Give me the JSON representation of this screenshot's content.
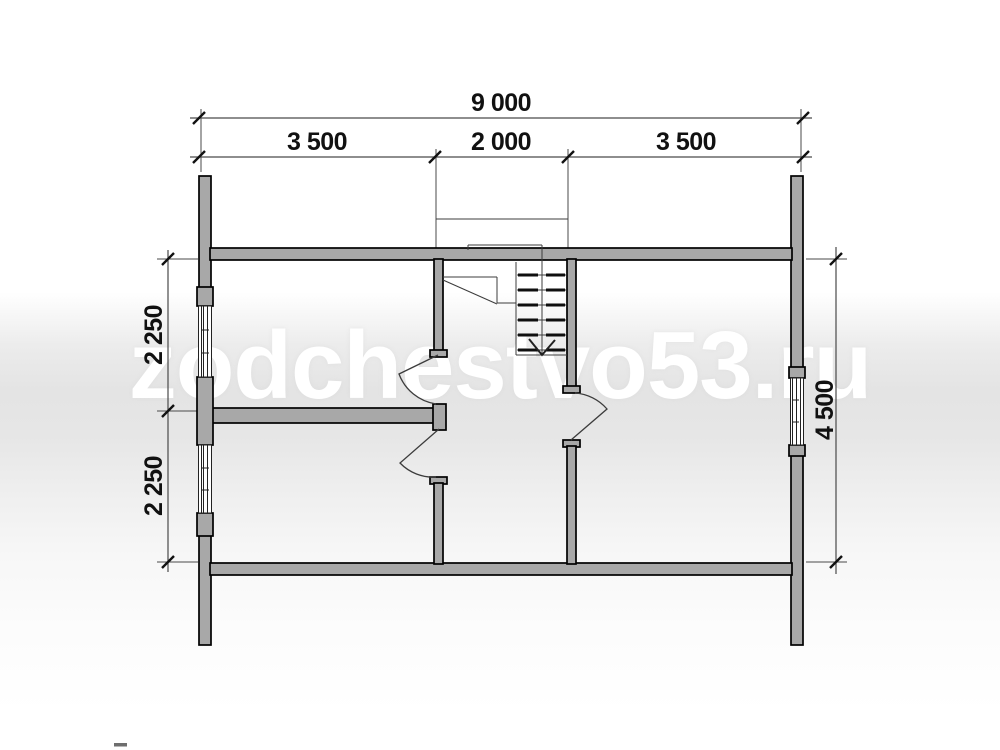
{
  "watermark": {
    "text": "zodchestvo53.ru"
  },
  "dimensions": {
    "overall_width": "9 000",
    "top_segments": [
      "3 500",
      "2 000",
      "3 500"
    ],
    "left_segments": [
      "2 250",
      "2 250"
    ],
    "right_height": "4 500"
  },
  "colors": {
    "wall_fill": "#a8a8a8",
    "wall_outline": "#000000",
    "dimension_text": "#111111",
    "watermark_text": "#ffffff",
    "background_band": "#e5e5e5"
  }
}
